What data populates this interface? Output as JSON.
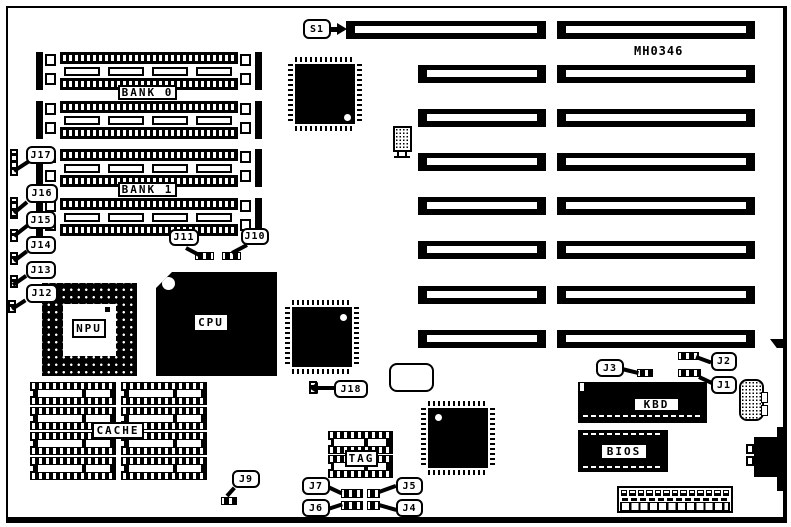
{
  "diagram": {
    "board_id": "MH0346",
    "colors": {
      "ink": "#000000",
      "paper": "#ffffff"
    },
    "chip_labels": {
      "bank0": "BANK 0",
      "bank1": "BANK 1",
      "npu": "NPU",
      "cpu": "CPU",
      "cache": "CACHE",
      "tag": "TAG",
      "kbd": "KBD",
      "bios": "BIOS"
    },
    "callouts": {
      "s1": "S1",
      "j1": "J1",
      "j2": "J2",
      "j3": "J3",
      "j4": "J4",
      "j5": "J5",
      "j6": "J6",
      "j7": "J7",
      "j9": "J9",
      "j10": "J10",
      "j11": "J11",
      "j12": "J12",
      "j13": "J13",
      "j14": "J14",
      "j15": "J15",
      "j16": "J16",
      "j17": "J17",
      "j18": "J18"
    }
  }
}
